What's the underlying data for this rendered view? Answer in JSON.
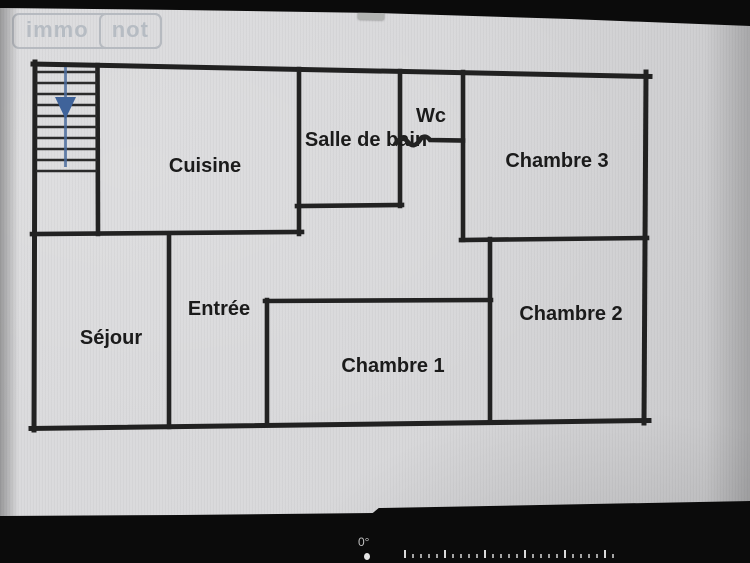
{
  "logo": {
    "part1": "immo",
    "part2": "not"
  },
  "floor_plan": {
    "rooms": [
      {
        "id": "cuisine",
        "label": "Cuisine"
      },
      {
        "id": "salle-de-bain",
        "label": "Salle de bain"
      },
      {
        "id": "wc",
        "label": "Wc"
      },
      {
        "id": "chambre-3",
        "label": "Chambre 3"
      },
      {
        "id": "sejour",
        "label": "Séjour"
      },
      {
        "id": "entree",
        "label": "Entrée"
      },
      {
        "id": "chambre-1",
        "label": "Chambre 1"
      },
      {
        "id": "chambre-2",
        "label": "Chambre 2"
      }
    ],
    "wall_color": "#212121",
    "stairs_arrow_color": "#4a6b9d"
  },
  "camera_overlay": {
    "angle_text": "0°"
  },
  "colors": {
    "screen_background": "#d7d7d9",
    "logo_gray": "#b5bbc2",
    "bezel_black": "#0b0b0b"
  }
}
